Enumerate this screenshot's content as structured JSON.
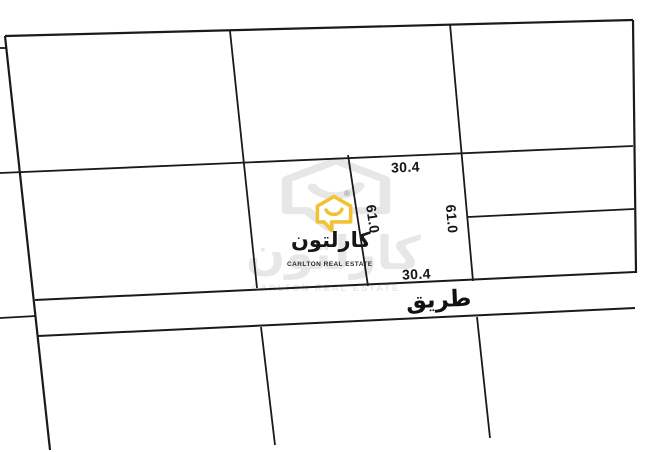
{
  "page": {
    "width": 668,
    "height": 452,
    "background": "#ffffff",
    "description": "Land plot survey map with highlighted central parcel and road"
  },
  "diagram": {
    "type": "land-plot-map",
    "line_color": "#1a1a1a",
    "labels": {
      "top_width": "30.4",
      "bottom_width": "30.4",
      "left_length": "61.0",
      "right_length": "61.0",
      "road": "طريق"
    },
    "segments": [
      {
        "name": "top-boundary",
        "x1": 5,
        "y1": 36,
        "x2": 633,
        "y2": 20,
        "w": 2.2
      },
      {
        "name": "left-boundary",
        "x1": 5,
        "y1": 36,
        "x2": 50,
        "y2": 450,
        "w": 2.2
      },
      {
        "name": "right-boundary",
        "x1": 633,
        "y1": 20,
        "x2": 636,
        "y2": 273,
        "w": 2.2
      },
      {
        "name": "top-left-stub",
        "x1": 0,
        "y1": 48,
        "x2": 7,
        "y2": 48,
        "w": 1.8
      },
      {
        "name": "upper-cross-line",
        "x1": 0,
        "y1": 173,
        "x2": 633,
        "y2": 146,
        "w": 1.8
      },
      {
        "name": "divider-a",
        "x1": 230,
        "y1": 31,
        "x2": 257,
        "y2": 288,
        "w": 1.8
      },
      {
        "name": "center-plot-left-edge",
        "x1": 348,
        "y1": 155,
        "x2": 368,
        "y2": 286,
        "w": 1.8
      },
      {
        "name": "center-plot-right-edge",
        "x1": 450,
        "y1": 24,
        "x2": 473,
        "y2": 281,
        "w": 1.8
      },
      {
        "name": "right-column-divider",
        "x1": 468,
        "y1": 217,
        "x2": 634,
        "y2": 209,
        "w": 1.8
      },
      {
        "name": "road-top-edge",
        "x1": 35,
        "y1": 300,
        "x2": 635,
        "y2": 272,
        "w": 2
      },
      {
        "name": "road-bottom-edge",
        "x1": 38,
        "y1": 336,
        "x2": 635,
        "y2": 308,
        "w": 2
      },
      {
        "name": "left-road-stub",
        "x1": 0,
        "y1": 318,
        "x2": 36,
        "y2": 316,
        "w": 1.8
      },
      {
        "name": "below-road-divider-left",
        "x1": 261,
        "y1": 327,
        "x2": 275,
        "y2": 445,
        "w": 1.8
      },
      {
        "name": "below-road-divider-right",
        "x1": 477,
        "y1": 317,
        "x2": 490,
        "y2": 438,
        "w": 1.8
      }
    ]
  },
  "branding": {
    "name_arabic": "كارلتون",
    "name_english": "CARLTON REAL ESTATE",
    "registered_mark": "®",
    "logo_color": "#f1c233",
    "text_color": "#161616",
    "watermark_color": "#c7c7c7"
  }
}
